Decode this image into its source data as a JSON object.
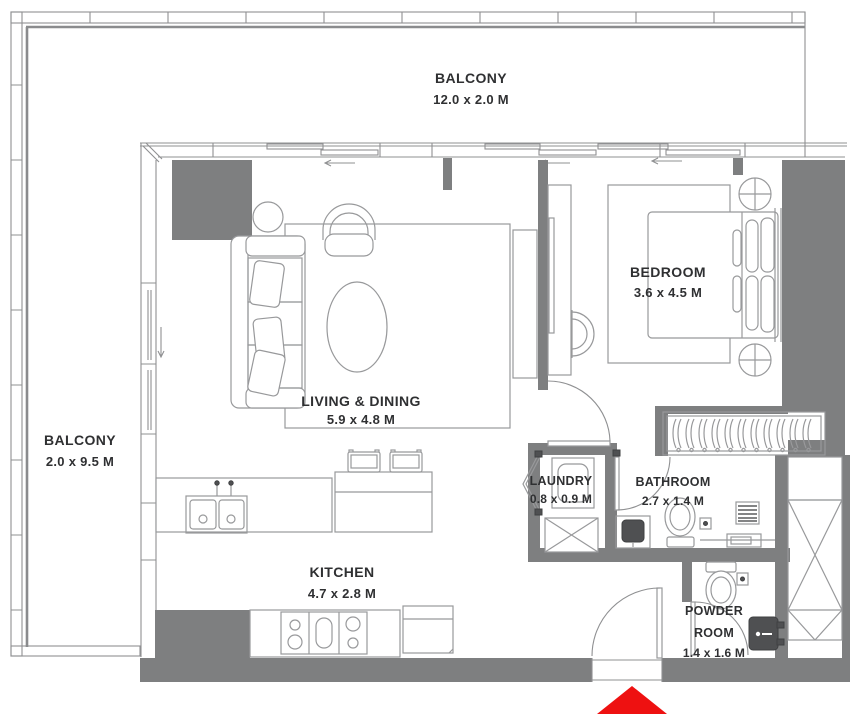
{
  "plan": {
    "balcony_top": {
      "name": "BALCONY",
      "dims": "12.0 x 2.0 M"
    },
    "balcony_left": {
      "name": "BALCONY",
      "dims": "2.0 x 9.5 M"
    },
    "living": {
      "name": "LIVING & DINING",
      "dims": "5.9 x 4.8 M"
    },
    "bedroom": {
      "name": "BEDROOM",
      "dims": "3.6 x 4.5 M"
    },
    "kitchen": {
      "name": "KITCHEN",
      "dims": "4.7 x 2.8 M"
    },
    "laundry": {
      "name": "LAUNDRY",
      "dims": "0.8 x 0.9 M"
    },
    "bathroom": {
      "name": "BATHROOM",
      "dims": "2.7 x 1.4 M"
    },
    "powder_room": {
      "line1": "POWDER",
      "line2": "ROOM",
      "dims": "1.4 x 1.6 M"
    }
  },
  "icons": {
    "entrance_marker": "red-up-triangle-entry-arrow"
  },
  "colors": {
    "wall_gray": "#7e7f80",
    "furniture_line_gray": "#98999b",
    "label_text": "#2f3032",
    "entrance_arrow_red": "#ee1111"
  }
}
